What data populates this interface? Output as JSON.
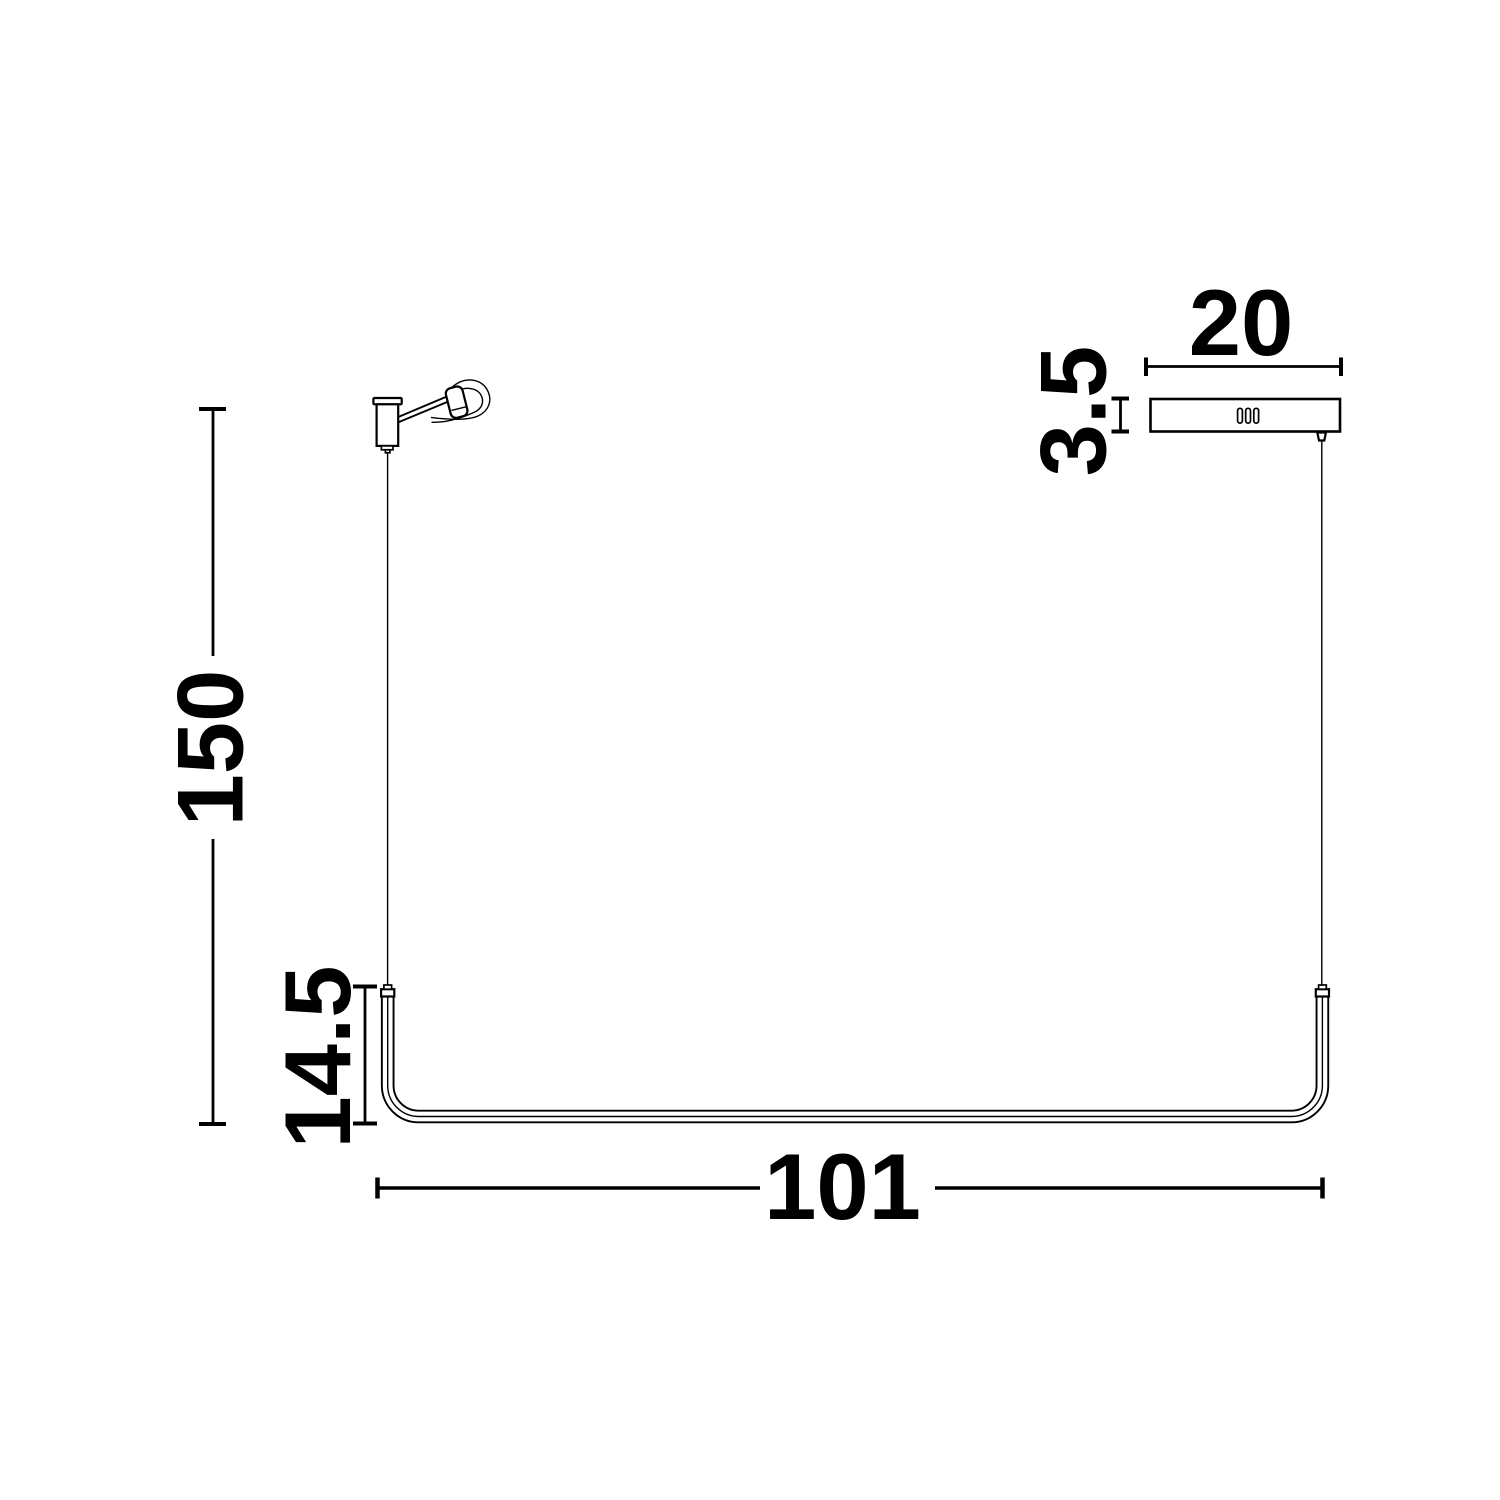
{
  "drawing": {
    "background_color": "#ffffff",
    "line_color": "#000000",
    "dimensions": {
      "suspension_height": "150",
      "end_height": "14.5",
      "bar_length": "101",
      "canopy_width": "20",
      "canopy_height": "3.5"
    }
  }
}
